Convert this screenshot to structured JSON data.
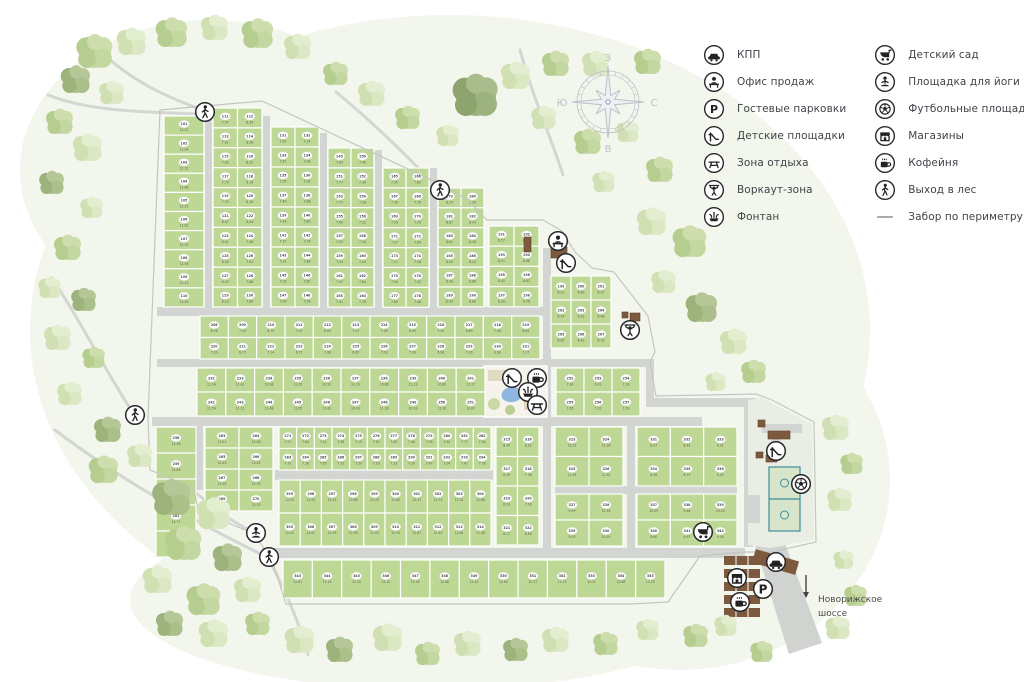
{
  "legend": {
    "columns": [
      [
        {
          "icon": "car",
          "label": "КПП"
        },
        {
          "icon": "sales",
          "label": "Офис продаж"
        },
        {
          "icon": "parking",
          "label": "Гостевые парковки"
        },
        {
          "icon": "slide",
          "label": "Детские площадки"
        },
        {
          "icon": "bench",
          "label": "Зона отдыха"
        },
        {
          "icon": "workout",
          "label": "Воркаут-зона"
        },
        {
          "icon": "fountain",
          "label": "Фонтан"
        }
      ],
      [
        {
          "icon": "stroller",
          "label": "Детский сад"
        },
        {
          "icon": "yoga",
          "label": "Площадка для йоги"
        },
        {
          "icon": "football",
          "label": "Футбольные площадки"
        },
        {
          "icon": "shop",
          "label": "Магазины"
        },
        {
          "icon": "coffee",
          "label": "Кофейня"
        },
        {
          "icon": "walk",
          "label": "Выход в лес"
        },
        {
          "icon": "fence",
          "label": "Забор по периметру"
        }
      ]
    ]
  },
  "compass": {
    "cx": 608,
    "cy": 102,
    "letters": {
      "top": "З",
      "right": "С",
      "bottom": "В",
      "left": "Ю"
    }
  },
  "map": {
    "colors": {
      "plot": "#bdd795",
      "plotStroke": "#ffffff",
      "road": "#d2d5d1",
      "meadow": "#f2f6ec",
      "path": "#d3d6d2",
      "fence": "#c3c7c3",
      "oval": "#ffffff",
      "num": "#4a4f45",
      "area": "#59604f",
      "brown": "#7d5a3d",
      "pond": "#8fb6e0",
      "parkBase": "#f6f3ec",
      "parkPath": "#e2d9c2",
      "amenity": "#e9ede3",
      "highway": "#d0d3cf",
      "teal": "#3a8f99",
      "icon": "#222222",
      "compass": "#b9c0c7",
      "label": "#4b4b4b"
    },
    "highway_label": [
      "Новорижское",
      "шоссе"
    ],
    "block_fields": [
      "name",
      "x",
      "y",
      "w",
      "cols",
      "rows",
      "ph",
      "start",
      "areaBase"
    ],
    "blocks": [
      [
        "A",
        164,
        116,
        40,
        1,
        10,
        19.1,
        101,
        12.2
      ],
      [
        "B",
        213,
        108,
        49,
        2,
        10,
        19.9,
        111,
        8.1
      ],
      [
        "C",
        271,
        127,
        48,
        2,
        9,
        20.0,
        131,
        7.6
      ],
      [
        "D",
        328,
        148,
        46,
        2,
        8,
        19.9,
        149,
        7.5
      ],
      [
        "E",
        383,
        168,
        46,
        2,
        7,
        19.9,
        165,
        7.6
      ],
      [
        "F",
        438,
        188,
        46,
        2,
        6,
        19.8,
        179,
        8.5
      ],
      [
        "G",
        489,
        226,
        50,
        2,
        4,
        20.2,
        191,
        8.7
      ],
      [
        "H",
        551,
        276,
        60,
        3,
        3,
        24.0,
        199,
        6.6
      ],
      [
        "S1",
        200,
        316,
        340,
        12,
        2,
        21.5,
        208,
        7.0
      ],
      [
        "S2a",
        197,
        368,
        288,
        10,
        2,
        24.0,
        232,
        11.2
      ],
      [
        "S2b",
        556,
        368,
        84,
        3,
        2,
        24.0,
        252,
        7.3
      ],
      [
        "L1",
        156,
        427,
        40,
        1,
        5,
        26.0,
        258,
        14.6
      ],
      [
        "L2",
        205,
        427,
        68,
        2,
        4,
        21.0,
        263,
        13.4
      ],
      [
        "M",
        279,
        427,
        212,
        12,
        2,
        21.5,
        271,
        7.4
      ],
      [
        "N",
        279,
        480,
        212,
        10,
        2,
        33.0,
        295,
        12.6
      ],
      [
        "O",
        496,
        427,
        43,
        2,
        4,
        29.5,
        315,
        8.3
      ],
      [
        "P2",
        555,
        427,
        68,
        2,
        2,
        29.5,
        323,
        12.1
      ],
      [
        "P3",
        555,
        494,
        68,
        2,
        2,
        26.0,
        327,
        10.2
      ],
      [
        "Qr",
        637,
        427,
        100,
        3,
        2,
        29.5,
        331,
        8.4
      ],
      [
        "Kr",
        637,
        494,
        100,
        3,
        2,
        26.0,
        337,
        9.8
      ],
      [
        "BR",
        283,
        560,
        382,
        13,
        1,
        38.0,
        343,
        12.5
      ]
    ],
    "roads": [
      [
        205,
        106,
        7,
        210
      ],
      [
        263,
        116,
        7,
        200
      ],
      [
        320,
        133,
        7,
        183
      ],
      [
        375,
        150,
        7,
        166
      ],
      [
        430,
        168,
        7,
        148
      ],
      [
        157,
        307,
        386,
        9
      ],
      [
        157,
        359,
        454,
        8
      ],
      [
        611,
        359,
        35,
        8
      ],
      [
        646,
        359,
        8,
        48
      ],
      [
        646,
        398,
        110,
        9
      ],
      [
        152,
        417,
        550,
        9
      ],
      [
        196,
        417,
        7,
        73
      ],
      [
        275,
        470,
        218,
        10
      ],
      [
        543,
        248,
        8,
        308
      ],
      [
        627,
        417,
        8,
        131
      ],
      [
        555,
        486,
        182,
        8
      ],
      [
        744,
        400,
        9,
        147
      ],
      [
        262,
        548,
        483,
        10
      ]
    ],
    "park": {
      "x": 484,
      "y": 366,
      "w": 63,
      "h": 51
    },
    "amenity": {
      "outline": "748,400 762,398 812,424 814,540 770,548 748,545",
      "grayRects": [
        [
          762,
          424,
          40,
          9
        ],
        [
          771,
          433,
          9,
          26
        ],
        [
          744,
          495,
          16,
          28
        ]
      ],
      "football": {
        "x": 769,
        "y": 467,
        "w": 31,
        "h": 64
      }
    },
    "entrance": {
      "highway": "747,519 776,519 822,643 789,654",
      "gate": [
        753,
        555,
        45,
        14
      ],
      "parkingBars": [
        [
          724,
          556
        ],
        [
          724,
          569
        ],
        [
          724,
          582
        ],
        [
          724,
          595
        ],
        [
          724,
          608
        ]
      ],
      "arrow": {
        "x": 806,
        "y1": 575,
        "y2": 597
      }
    },
    "brownRects": [
      [
        551,
        247,
        16,
        11
      ],
      [
        524,
        237,
        7,
        15
      ],
      [
        622,
        312,
        6,
        6
      ],
      [
        630,
        313,
        10,
        8
      ],
      [
        758,
        420,
        7,
        7
      ],
      [
        768,
        431,
        22,
        8
      ],
      [
        756,
        452,
        7,
        6
      ],
      [
        766,
        455,
        11,
        7
      ]
    ],
    "forestPaths": [
      "M88,38 C120,75 160,95 203,110",
      "M48,95 C90,112 150,112 200,114",
      "M52,278 C80,320 105,370 133,413",
      "M55,430 C110,472 190,520 265,556",
      "M178,478 C210,505 235,525 254,532",
      "M268,558 C288,595 300,625 308,655",
      "M336,92 C370,120 410,158 437,188",
      "M520,50 C532,95 552,140 563,175"
    ],
    "fence": "160,110 262,101 438,183 468,200 487,220 543,220 562,231 575,252 592,268 614,272 648,316 655,352 650,362 656,396 756,394 772,400 814,422 816,542 772,552 746,552 700,556 668,602 630,604 286,604 272,560 254,534 198,510 194,488 150,470 148,418",
    "icons": [
      {
        "type": "walk",
        "x": 205,
        "y": 112
      },
      {
        "type": "walk",
        "x": 440,
        "y": 190
      },
      {
        "type": "walk",
        "x": 135,
        "y": 415
      },
      {
        "type": "walk",
        "x": 269,
        "y": 557
      },
      {
        "type": "yoga",
        "x": 256,
        "y": 533
      },
      {
        "type": "sales",
        "x": 558,
        "y": 241
      },
      {
        "type": "slide",
        "x": 566,
        "y": 263
      },
      {
        "type": "workout",
        "x": 630,
        "y": 330
      },
      {
        "type": "slide",
        "x": 512,
        "y": 378
      },
      {
        "type": "coffee",
        "x": 537,
        "y": 378
      },
      {
        "type": "fountain",
        "x": 528,
        "y": 392
      },
      {
        "type": "bench",
        "x": 537,
        "y": 405
      },
      {
        "type": "slide",
        "x": 776,
        "y": 451
      },
      {
        "type": "football",
        "x": 801,
        "y": 484
      },
      {
        "type": "stroller",
        "x": 703,
        "y": 532
      },
      {
        "type": "car",
        "x": 776,
        "y": 562
      },
      {
        "type": "shop",
        "x": 737,
        "y": 578
      },
      {
        "type": "parking",
        "x": 763,
        "y": 589
      },
      {
        "type": "coffee",
        "x": 740,
        "y": 602
      }
    ],
    "trees": [
      [
        95,
        52,
        16,
        "mid"
      ],
      [
        132,
        42,
        13,
        "light"
      ],
      [
        172,
        33,
        14,
        "mid"
      ],
      [
        215,
        28,
        12,
        "light"
      ],
      [
        258,
        34,
        14,
        "mid"
      ],
      [
        298,
        47,
        12,
        "light"
      ],
      [
        76,
        80,
        13,
        "olive"
      ],
      [
        112,
        93,
        11,
        "light"
      ],
      [
        60,
        122,
        12,
        "mid"
      ],
      [
        88,
        148,
        13,
        "light"
      ],
      [
        52,
        183,
        11,
        "olive"
      ],
      [
        92,
        208,
        10,
        "light"
      ],
      [
        336,
        74,
        11,
        "mid"
      ],
      [
        372,
        94,
        12,
        "light"
      ],
      [
        408,
        118,
        11,
        "mid"
      ],
      [
        448,
        136,
        10,
        "light"
      ],
      [
        476,
        96,
        20,
        "dark"
      ],
      [
        516,
        76,
        13,
        "light"
      ],
      [
        556,
        64,
        12,
        "mid"
      ],
      [
        596,
        64,
        12,
        "light"
      ],
      [
        648,
        62,
        12,
        "mid"
      ],
      [
        544,
        118,
        11,
        "light"
      ],
      [
        588,
        142,
        12,
        "mid"
      ],
      [
        628,
        132,
        10,
        "light"
      ],
      [
        660,
        170,
        12,
        "mid"
      ],
      [
        604,
        182,
        10,
        "light"
      ],
      [
        652,
        222,
        13,
        "light"
      ],
      [
        690,
        242,
        15,
        "mid"
      ],
      [
        664,
        282,
        11,
        "light"
      ],
      [
        702,
        308,
        14,
        "olive"
      ],
      [
        734,
        342,
        12,
        "light"
      ],
      [
        754,
        372,
        11,
        "mid"
      ],
      [
        716,
        382,
        9,
        "light"
      ],
      [
        836,
        428,
        12,
        "light"
      ],
      [
        852,
        464,
        10,
        "mid"
      ],
      [
        840,
        500,
        11,
        "light"
      ],
      [
        68,
        248,
        12,
        "mid"
      ],
      [
        50,
        288,
        10,
        "light"
      ],
      [
        84,
        300,
        11,
        "olive"
      ],
      [
        58,
        338,
        12,
        "light"
      ],
      [
        94,
        358,
        10,
        "mid"
      ],
      [
        70,
        394,
        11,
        "light"
      ],
      [
        108,
        430,
        12,
        "olive"
      ],
      [
        140,
        456,
        11,
        "light"
      ],
      [
        104,
        470,
        13,
        "mid"
      ],
      [
        172,
        498,
        17,
        "olive"
      ],
      [
        214,
        514,
        15,
        "light"
      ],
      [
        184,
        544,
        16,
        "mid"
      ],
      [
        228,
        558,
        13,
        "olive"
      ],
      [
        158,
        580,
        13,
        "light"
      ],
      [
        204,
        600,
        15,
        "mid"
      ],
      [
        248,
        590,
        12,
        "light"
      ],
      [
        170,
        624,
        12,
        "olive"
      ],
      [
        214,
        634,
        13,
        "light"
      ],
      [
        258,
        624,
        11,
        "mid"
      ],
      [
        300,
        640,
        13,
        "light"
      ],
      [
        340,
        650,
        12,
        "olive"
      ],
      [
        388,
        638,
        13,
        "light"
      ],
      [
        428,
        654,
        11,
        "mid"
      ],
      [
        468,
        644,
        12,
        "light"
      ],
      [
        516,
        650,
        11,
        "olive"
      ],
      [
        556,
        640,
        12,
        "light"
      ],
      [
        606,
        644,
        11,
        "mid"
      ],
      [
        648,
        630,
        10,
        "light"
      ],
      [
        696,
        636,
        11,
        "mid"
      ],
      [
        726,
        626,
        10,
        "light"
      ],
      [
        762,
        652,
        10,
        "mid"
      ],
      [
        838,
        628,
        11,
        "light"
      ],
      [
        856,
        596,
        10,
        "mid"
      ],
      [
        844,
        560,
        9,
        "light"
      ]
    ]
  }
}
